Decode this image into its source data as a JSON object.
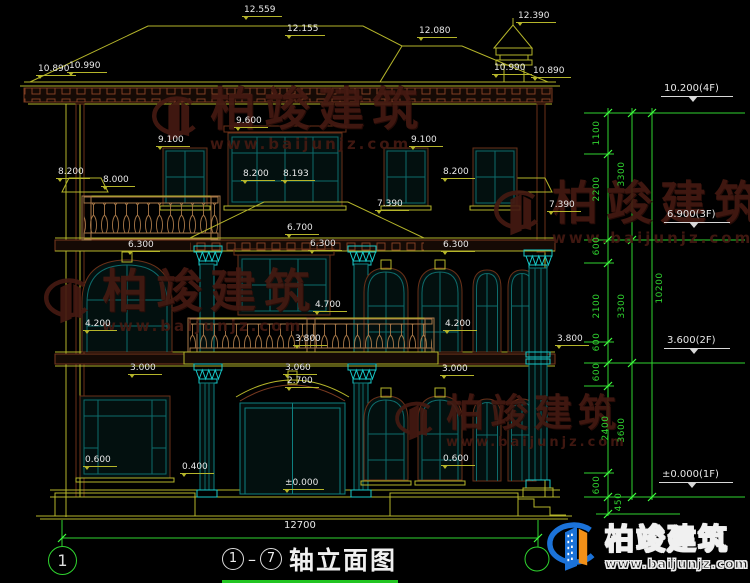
{
  "drawing": {
    "title": "轴立面图",
    "axis_start": "1",
    "axis_end": "7"
  },
  "watermark": {
    "name": "柏竣建筑",
    "url": "www.baijunjz.com"
  },
  "dim_labels": [
    {
      "text": "12.559",
      "x": 242,
      "y": 5
    },
    {
      "text": "12.155",
      "x": 285,
      "y": 24
    },
    {
      "text": "12.080",
      "x": 417,
      "y": 26
    },
    {
      "text": "12.390",
      "x": 516,
      "y": 11
    },
    {
      "text": "10.890",
      "x": 36,
      "y": 64
    },
    {
      "text": "10.990",
      "x": 67,
      "y": 61
    },
    {
      "text": "10.990",
      "x": 492,
      "y": 63
    },
    {
      "text": "10.890",
      "x": 531,
      "y": 66
    },
    {
      "text": "9.600",
      "x": 234,
      "y": 116
    },
    {
      "text": "9.100",
      "x": 156,
      "y": 135
    },
    {
      "text": "9.100",
      "x": 409,
      "y": 135
    },
    {
      "text": "8.200",
      "x": 56,
      "y": 167
    },
    {
      "text": "8.000",
      "x": 101,
      "y": 175
    },
    {
      "text": "8.200",
      "x": 241,
      "y": 169
    },
    {
      "text": "8.193",
      "x": 281,
      "y": 169
    },
    {
      "text": "8.200",
      "x": 441,
      "y": 167
    },
    {
      "text": "7.390",
      "x": 375,
      "y": 199
    },
    {
      "text": "7.390",
      "x": 547,
      "y": 200
    },
    {
      "text": "6.700",
      "x": 285,
      "y": 223
    },
    {
      "text": "6.300",
      "x": 126,
      "y": 240
    },
    {
      "text": "6.300",
      "x": 308,
      "y": 239
    },
    {
      "text": "6.300",
      "x": 441,
      "y": 240
    },
    {
      "text": "4.700",
      "x": 313,
      "y": 300
    },
    {
      "text": "4.200",
      "x": 83,
      "y": 319
    },
    {
      "text": "4.200",
      "x": 443,
      "y": 319
    },
    {
      "text": "3.800",
      "x": 293,
      "y": 334
    },
    {
      "text": "3.800",
      "x": 555,
      "y": 334
    },
    {
      "text": "3.000",
      "x": 128,
      "y": 363
    },
    {
      "text": "3.060",
      "x": 283,
      "y": 363
    },
    {
      "text": "2.700",
      "x": 285,
      "y": 376
    },
    {
      "text": "3.000",
      "x": 440,
      "y": 364
    },
    {
      "text": "0.600",
      "x": 83,
      "y": 455
    },
    {
      "text": "0.400",
      "x": 180,
      "y": 462
    },
    {
      "text": "±0.000",
      "x": 283,
      "y": 478
    },
    {
      "text": "0.600",
      "x": 441,
      "y": 454
    },
    {
      "text": "12700",
      "x": 284,
      "y": 520,
      "style": "plain"
    }
  ],
  "level_markers": [
    {
      "text": "10.200(4F)",
      "x": 661,
      "y": 83
    },
    {
      "text": "6.900(3F)",
      "x": 664,
      "y": 209
    },
    {
      "text": "3.600(2F)",
      "x": 664,
      "y": 335
    },
    {
      "text": "±0.000(1F)",
      "x": 659,
      "y": 469
    }
  ],
  "green_dims": [
    {
      "text": "1100",
      "x": 597,
      "y": 134
    },
    {
      "text": "3300",
      "x": 622,
      "y": 175
    },
    {
      "text": "2200",
      "x": 597,
      "y": 190
    },
    {
      "text": "600",
      "x": 597,
      "y": 247
    },
    {
      "text": "2100",
      "x": 597,
      "y": 307
    },
    {
      "text": "3300",
      "x": 622,
      "y": 307
    },
    {
      "text": "10200",
      "x": 660,
      "y": 289
    },
    {
      "text": "600",
      "x": 597,
      "y": 343
    },
    {
      "text": "600",
      "x": 597,
      "y": 373
    },
    {
      "text": "2400",
      "x": 606,
      "y": 429
    },
    {
      "text": "3600",
      "x": 622,
      "y": 431
    },
    {
      "text": "600",
      "x": 597,
      "y": 486
    },
    {
      "text": "450",
      "x": 619,
      "y": 503
    }
  ],
  "colors": {
    "background": "#000000",
    "line_yellow": "#b5b52a",
    "dim_green": "#2fd42f",
    "accent_cyan": "#17c9c9",
    "frame_teal": "#0e6b6b",
    "band_brown": "#7a3a20",
    "baluster_tan": "#a87848",
    "watermark_maroon": "#451a12",
    "logo_blue": "#1b72d8",
    "logo_orange": "#f29018"
  }
}
